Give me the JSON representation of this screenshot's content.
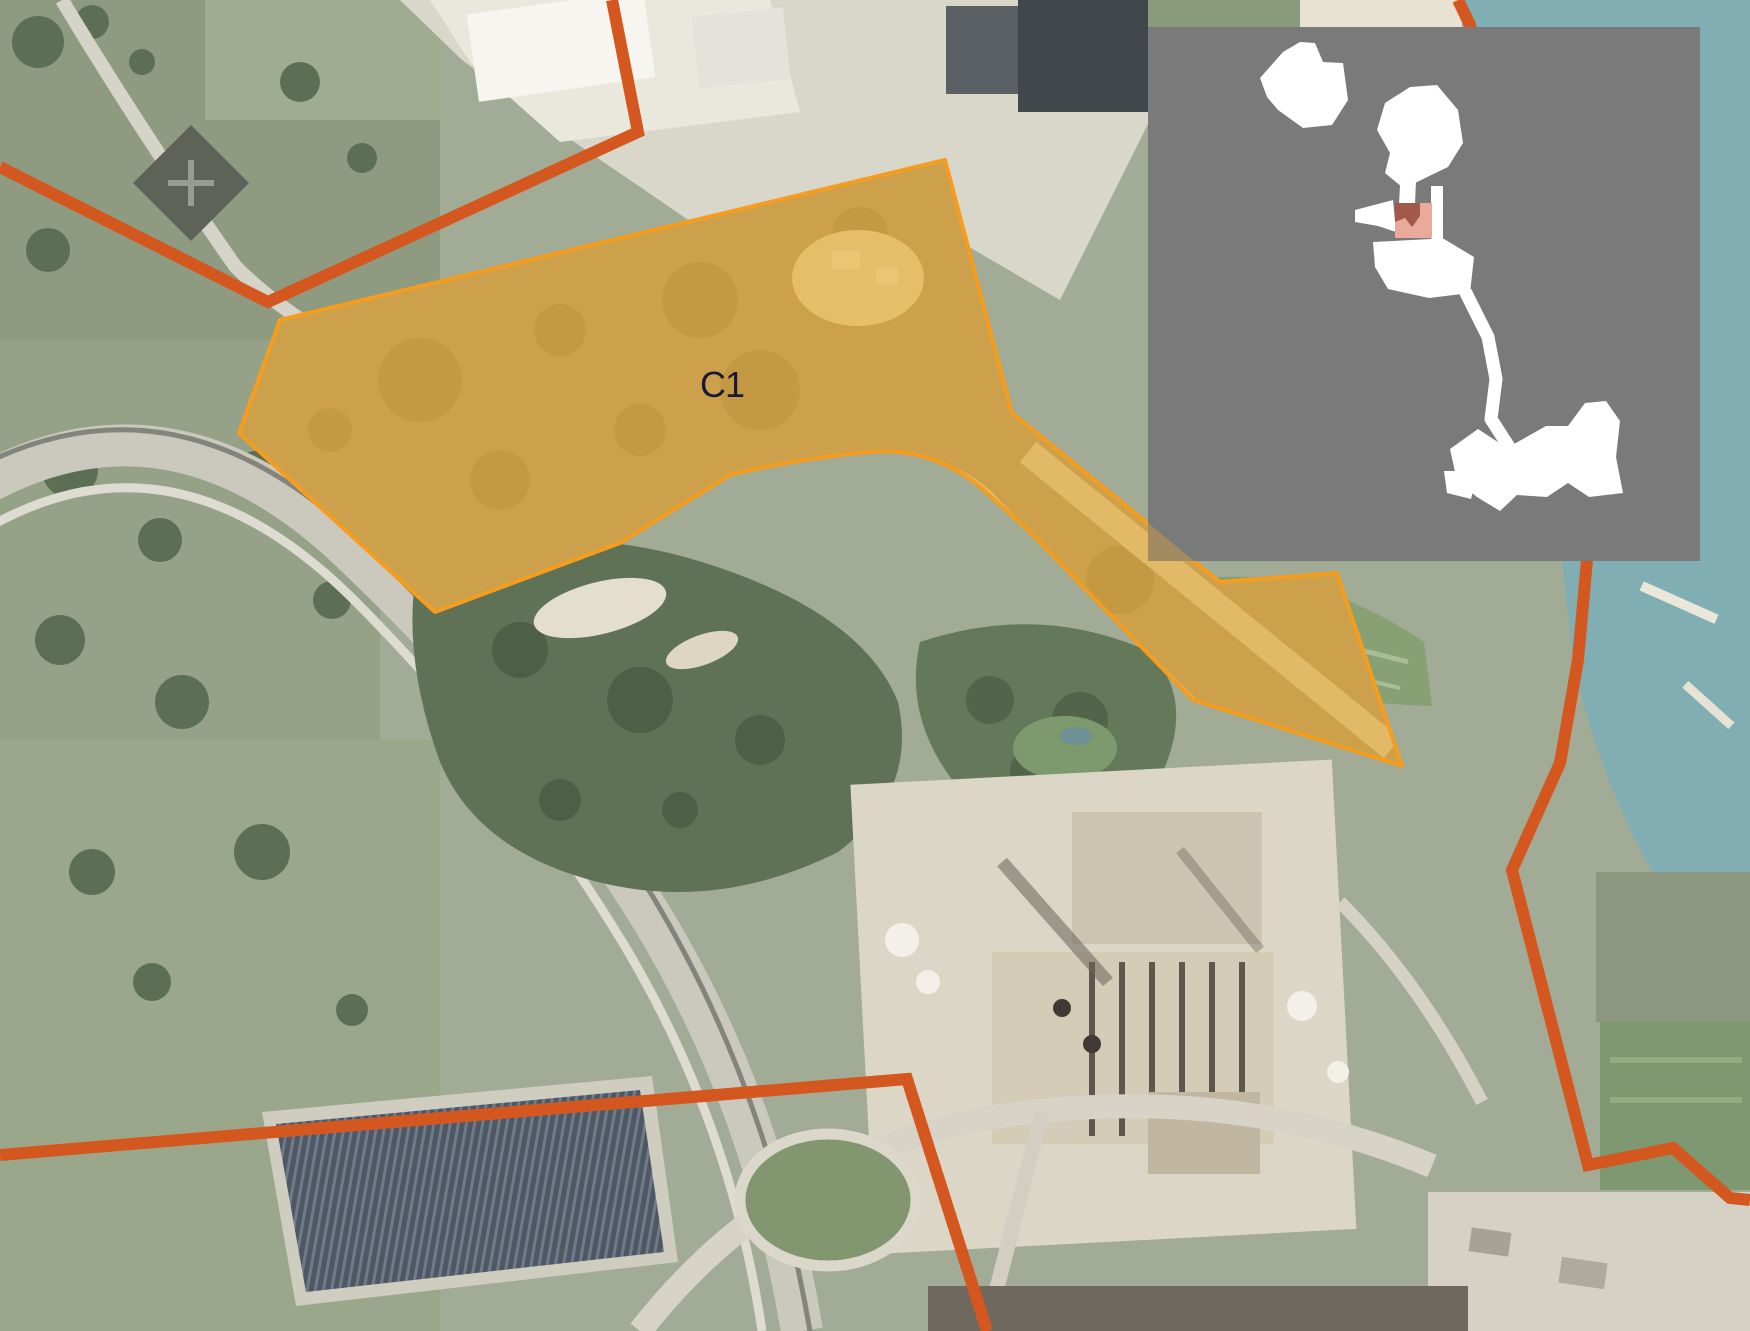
{
  "map": {
    "zone": {
      "label": "C1"
    },
    "colors": {
      "boundary": "#d4571f",
      "zone_fill": "#f0ac34",
      "zone_border": "#f49d1e",
      "zone_label": "#1a1a38",
      "inset_bg": "#7a7a7a",
      "inset_land": "#ffffff",
      "inset_highlight": "#e9aa9b",
      "inset_highlight_dark": "#a3594a",
      "water": "#81aeb2"
    }
  }
}
